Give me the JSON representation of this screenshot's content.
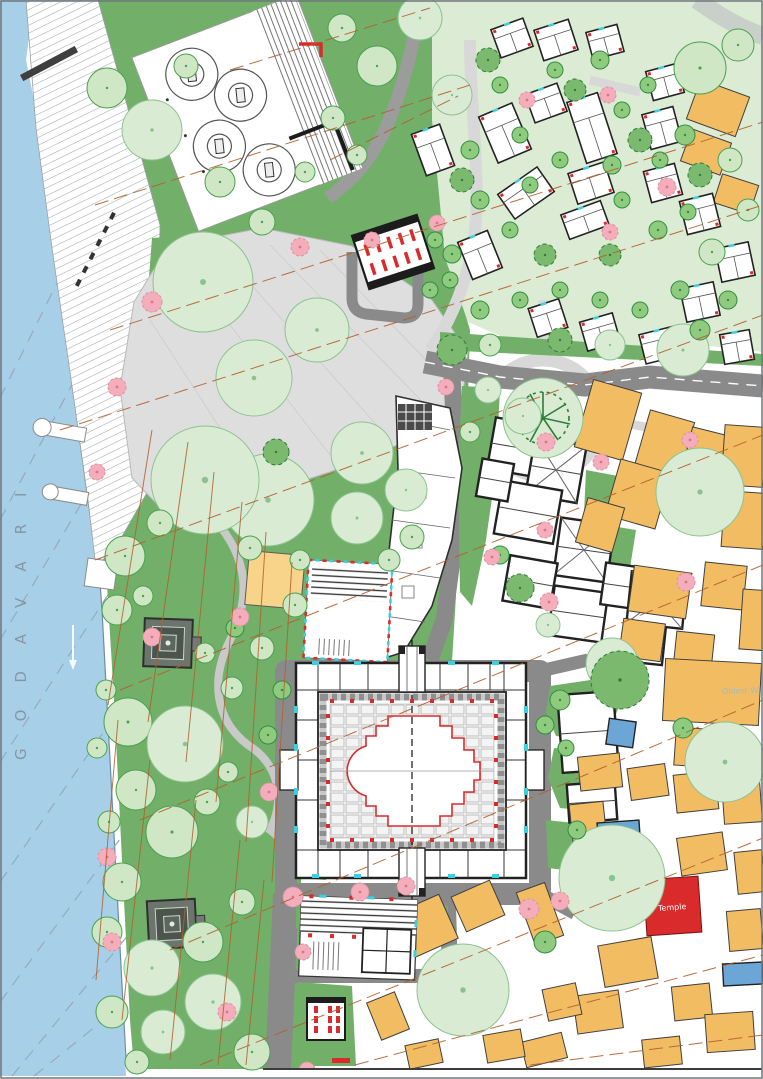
{
  "title": "Riverfront temple precinct master plan",
  "labels": {
    "river_name": "GODAVARI",
    "temple": "Temple",
    "note": "Oldest W"
  },
  "colors": {
    "river": "#a7d0e8",
    "riverEdge": "#6b8da6",
    "riverDash": "#93aabf",
    "park": "#72b069",
    "pale_bg": "#dcebd4",
    "plaza": "#dedede",
    "plazaEdge": "#b8b8b8",
    "road": "#8a8a8a",
    "roadLight": "#d8d8d8",
    "pathLight": "#c9cfc9",
    "treeLight": "#cfe7c4",
    "treeLightEdge": "#4aa050",
    "treePale": "#d9ecd3",
    "treePaleEdge": "#8cc290",
    "treeBright": "#8fca7f",
    "treeBrightEdge": "#2f8f3f",
    "canopy": "#7ab96e",
    "canopyEdge": "#2e7d3a",
    "pink": "#f4adba",
    "pinkEdge": "#e08ea1",
    "orange": "#f2bd62",
    "orangeEdge": "#4a3a22",
    "yellow": "#f7d489",
    "wall": "#222222",
    "red": "#d92b2b",
    "cyan": "#3ccfe0",
    "blue": "#6ba6d6",
    "contour": "#b2602e",
    "label_gray": "#7f8d98",
    "label_blue": "#9fb9cf",
    "shrine": "#5a675c",
    "frame": "#6f767c"
  },
  "features": {
    "trees": [
      [
        107,
        88,
        20,
        0
      ],
      [
        152,
        130,
        30,
        1
      ],
      [
        186,
        66,
        12,
        0
      ],
      [
        220,
        182,
        15,
        0
      ],
      [
        262,
        222,
        13,
        0
      ],
      [
        342,
        28,
        14,
        0
      ],
      [
        377,
        66,
        20,
        0
      ],
      [
        420,
        18,
        22,
        1
      ],
      [
        333,
        118,
        12,
        0
      ],
      [
        305,
        172,
        10,
        0
      ],
      [
        357,
        155,
        10,
        0
      ],
      [
        452,
        95,
        20,
        1
      ],
      [
        700,
        68,
        26,
        0
      ],
      [
        738,
        45,
        16,
        0
      ],
      [
        748,
        210,
        11,
        0
      ],
      [
        730,
        160,
        12,
        0
      ],
      [
        712,
        252,
        13,
        0
      ],
      [
        203,
        282,
        50,
        1
      ],
      [
        254,
        378,
        38,
        1
      ],
      [
        317,
        330,
        32,
        1
      ],
      [
        268,
        500,
        46,
        1
      ],
      [
        205,
        480,
        54,
        1
      ],
      [
        362,
        453,
        31,
        1
      ],
      [
        357,
        518,
        26,
        1
      ],
      [
        406,
        490,
        21,
        1
      ],
      [
        412,
        537,
        12,
        0
      ],
      [
        389,
        560,
        11,
        0
      ],
      [
        125,
        556,
        20,
        0
      ],
      [
        160,
        523,
        13,
        0
      ],
      [
        117,
        610,
        15,
        0
      ],
      [
        143,
        596,
        10,
        0
      ],
      [
        106,
        690,
        10,
        0
      ],
      [
        128,
        722,
        24,
        0
      ],
      [
        185,
        744,
        38,
        1
      ],
      [
        136,
        790,
        20,
        0
      ],
      [
        109,
        822,
        11,
        0
      ],
      [
        172,
        832,
        26,
        0
      ],
      [
        228,
        772,
        10,
        0
      ],
      [
        207,
        802,
        13,
        0
      ],
      [
        252,
        822,
        16,
        1
      ],
      [
        122,
        882,
        19,
        0
      ],
      [
        107,
        932,
        15,
        0
      ],
      [
        152,
        968,
        28,
        1
      ],
      [
        203,
        942,
        20,
        0
      ],
      [
        242,
        902,
        13,
        0
      ],
      [
        112,
        1012,
        16,
        0
      ],
      [
        163,
        1032,
        22,
        1
      ],
      [
        213,
        1002,
        28,
        1
      ],
      [
        252,
        1052,
        18,
        0
      ],
      [
        137,
        1062,
        12,
        0
      ],
      [
        97,
        748,
        10,
        0
      ],
      [
        232,
        688,
        11,
        0
      ],
      [
        262,
        648,
        12,
        0
      ],
      [
        205,
        653,
        10,
        0
      ],
      [
        250,
        548,
        12,
        0
      ],
      [
        300,
        560,
        10,
        0
      ],
      [
        295,
        605,
        12,
        0
      ],
      [
        488,
        390,
        13,
        1
      ],
      [
        523,
        416,
        18,
        1
      ],
      [
        470,
        432,
        10,
        0
      ],
      [
        610,
        345,
        15,
        1
      ],
      [
        683,
        350,
        26,
        1
      ],
      [
        700,
        492,
        44,
        1
      ],
      [
        725,
        762,
        40,
        1
      ],
      [
        683,
        728,
        10,
        2
      ],
      [
        612,
        878,
        53,
        1
      ],
      [
        463,
        990,
        46,
        1
      ],
      [
        545,
        942,
        11,
        2
      ],
      [
        612,
        664,
        26,
        1
      ],
      [
        548,
        625,
        12,
        1
      ],
      [
        560,
        700,
        10,
        2
      ],
      [
        545,
        725,
        9,
        2
      ],
      [
        566,
        748,
        8,
        2
      ],
      [
        282,
        690,
        9,
        2
      ],
      [
        268,
        735,
        9,
        2
      ],
      [
        490,
        345,
        11,
        0
      ],
      [
        452,
        350,
        15,
        3
      ],
      [
        560,
        340,
        12,
        3
      ],
      [
        620,
        680,
        29,
        3
      ],
      [
        520,
        588,
        14,
        3
      ],
      [
        276,
        452,
        13,
        3
      ],
      [
        235,
        628,
        9,
        2
      ],
      [
        577,
        830,
        9,
        2
      ],
      [
        452,
        254,
        9,
        2
      ],
      [
        430,
        290,
        8,
        2
      ],
      [
        500,
        555,
        9,
        2
      ],
      [
        470,
        150,
        9,
        2
      ],
      [
        500,
        85,
        8,
        2
      ],
      [
        520,
        135,
        8,
        2
      ],
      [
        555,
        70,
        8,
        2
      ],
      [
        600,
        60,
        9,
        2
      ],
      [
        622,
        110,
        8,
        2
      ],
      [
        648,
        85,
        8,
        2
      ],
      [
        685,
        135,
        10,
        2
      ],
      [
        660,
        160,
        8,
        2
      ],
      [
        612,
        165,
        9,
        2
      ],
      [
        560,
        160,
        8,
        2
      ],
      [
        530,
        185,
        8,
        2
      ],
      [
        480,
        200,
        9,
        2
      ],
      [
        510,
        230,
        8,
        2
      ],
      [
        622,
        200,
        8,
        2
      ],
      [
        658,
        230,
        9,
        2
      ],
      [
        688,
        212,
        8,
        2
      ],
      [
        680,
        290,
        9,
        2
      ],
      [
        640,
        310,
        8,
        2
      ],
      [
        600,
        300,
        8,
        2
      ],
      [
        560,
        290,
        8,
        2
      ],
      [
        520,
        300,
        8,
        2
      ],
      [
        480,
        310,
        9,
        2
      ],
      [
        450,
        280,
        8,
        2
      ],
      [
        435,
        240,
        8,
        2
      ],
      [
        700,
        330,
        10,
        2
      ],
      [
        728,
        300,
        9,
        2
      ],
      [
        488,
        60,
        12,
        3
      ],
      [
        575,
        90,
        11,
        3
      ],
      [
        640,
        140,
        12,
        3
      ],
      [
        462,
        180,
        12,
        3
      ],
      [
        700,
        175,
        12,
        3
      ],
      [
        545,
        255,
        11,
        3
      ],
      [
        610,
        255,
        11,
        3
      ]
    ],
    "pink_trees": [
      [
        152,
        302,
        10
      ],
      [
        117,
        387,
        9
      ],
      [
        97,
        472,
        8
      ],
      [
        240,
        617,
        9
      ],
      [
        152,
        637,
        9
      ],
      [
        269,
        792,
        9
      ],
      [
        107,
        857,
        9
      ],
      [
        293,
        897,
        10
      ],
      [
        360,
        892,
        9
      ],
      [
        406,
        886,
        9
      ],
      [
        303,
        952,
        8
      ],
      [
        112,
        942,
        9
      ],
      [
        227,
        1012,
        9
      ],
      [
        307,
        1070,
        8
      ],
      [
        527,
        100,
        8
      ],
      [
        610,
        232,
        8
      ],
      [
        667,
        187,
        9
      ],
      [
        446,
        387,
        8
      ],
      [
        546,
        442,
        9
      ],
      [
        601,
        462,
        8
      ],
      [
        492,
        557,
        8
      ],
      [
        549,
        602,
        9
      ],
      [
        686,
        582,
        9
      ],
      [
        529,
        909,
        10
      ],
      [
        560,
        901,
        9
      ],
      [
        437,
        223,
        8
      ],
      [
        372,
        240,
        8
      ],
      [
        300,
        247,
        9
      ],
      [
        545,
        530,
        8
      ],
      [
        608,
        95,
        8
      ],
      [
        690,
        440,
        8
      ]
    ],
    "orange_buildings": [
      [
        718,
        108,
        52,
        42,
        20
      ],
      [
        706,
        152,
        42,
        34,
        20
      ],
      [
        736,
        194,
        38,
        30,
        18
      ],
      [
        608,
        420,
        50,
        70,
        16
      ],
      [
        664,
        446,
        46,
        62,
        16
      ],
      [
        638,
        494,
        52,
        58,
        16
      ],
      [
        600,
        525,
        38,
        46,
        16
      ],
      [
        700,
        472,
        36,
        84,
        14
      ],
      [
        744,
        456,
        42,
        60,
        4
      ],
      [
        744,
        520,
        42,
        56,
        4
      ],
      [
        660,
        592,
        58,
        46,
        8
      ],
      [
        724,
        586,
        42,
        44,
        6
      ],
      [
        642,
        640,
        42,
        38,
        8
      ],
      [
        694,
        650,
        38,
        34,
        6
      ],
      [
        712,
        692,
        96,
        62,
        3
      ],
      [
        704,
        748,
        58,
        38,
        4
      ],
      [
        756,
        620,
        30,
        60,
        4
      ],
      [
        600,
        772,
        42,
        34,
        -6
      ],
      [
        648,
        782,
        38,
        32,
        -8
      ],
      [
        696,
        792,
        42,
        38,
        -6
      ],
      [
        742,
        802,
        38,
        42,
        -4
      ],
      [
        588,
        822,
        34,
        38,
        -6
      ],
      [
        702,
        854,
        46,
        38,
        -8
      ],
      [
        750,
        872,
        28,
        42,
        -6
      ],
      [
        745,
        930,
        34,
        40,
        -5
      ],
      [
        628,
        962,
        54,
        42,
        -10
      ],
      [
        692,
        1002,
        38,
        34,
        -6
      ],
      [
        598,
        1012,
        46,
        38,
        -8
      ],
      [
        730,
        1032,
        48,
        38,
        -4
      ],
      [
        662,
        1052,
        38,
        28,
        -6
      ],
      [
        562,
        1002,
        34,
        32,
        -12
      ],
      [
        544,
        1050,
        42,
        26,
        -14
      ],
      [
        422,
        928,
        58,
        48,
        -24
      ],
      [
        478,
        906,
        42,
        38,
        -24
      ],
      [
        540,
        914,
        30,
        56,
        -20
      ],
      [
        504,
        1046,
        38,
        28,
        -10
      ],
      [
        424,
        1054,
        34,
        24,
        -12
      ],
      [
        388,
        1016,
        30,
        40,
        -22
      ]
    ],
    "villas": [
      [
        512,
        38,
        34,
        30,
        -20
      ],
      [
        556,
        40,
        36,
        32,
        -18
      ],
      [
        605,
        42,
        32,
        28,
        -15
      ],
      [
        665,
        82,
        32,
        30,
        -15
      ],
      [
        433,
        150,
        30,
        44,
        -20
      ],
      [
        505,
        133,
        36,
        50,
        -23
      ],
      [
        546,
        103,
        34,
        30,
        -20
      ],
      [
        592,
        128,
        32,
        64,
        -18
      ],
      [
        662,
        128,
        32,
        36,
        -15
      ],
      [
        591,
        183,
        38,
        32,
        -18
      ],
      [
        526,
        193,
        48,
        30,
        -35
      ],
      [
        585,
        220,
        42,
        26,
        -20
      ],
      [
        663,
        183,
        32,
        32,
        -15
      ],
      [
        700,
        214,
        34,
        34,
        -14
      ],
      [
        735,
        262,
        34,
        34,
        -12
      ],
      [
        700,
        302,
        34,
        34,
        -12
      ],
      [
        660,
        345,
        36,
        30,
        -14
      ],
      [
        600,
        332,
        34,
        30,
        -16
      ],
      [
        548,
        318,
        32,
        30,
        -18
      ],
      [
        737,
        347,
        30,
        30,
        -10
      ],
      [
        480,
        255,
        32,
        40,
        -22
      ]
    ],
    "heritage_buildings": [
      [
        520,
        448,
        58,
        52,
        10,
        0
      ],
      [
        556,
        470,
        52,
        58,
        10,
        1
      ],
      [
        528,
        512,
        60,
        54,
        10,
        0
      ],
      [
        584,
        550,
        54,
        58,
        8,
        1
      ],
      [
        530,
        582,
        48,
        46,
        10,
        0
      ],
      [
        578,
        614,
        54,
        50,
        8,
        0
      ],
      [
        622,
        586,
        38,
        42,
        8,
        0
      ],
      [
        495,
        480,
        32,
        38,
        10,
        0
      ],
      [
        657,
        600,
        56,
        52,
        6,
        1
      ],
      [
        643,
        644,
        42,
        38,
        6,
        0
      ],
      [
        588,
        732,
        56,
        78,
        -4,
        0
      ],
      [
        592,
        802,
        48,
        38,
        -4,
        0
      ]
    ],
    "blue_buildings": [
      [
        621,
        733,
        27,
        26,
        8
      ],
      [
        619,
        836,
        42,
        29,
        -4
      ],
      [
        743,
        974,
        40,
        22,
        -3
      ]
    ],
    "contours": [
      [
        95,
        205,
        470,
        85
      ],
      [
        110,
        330,
        763,
        122
      ],
      [
        60,
        430,
        763,
        205
      ],
      [
        95,
        560,
        763,
        315
      ],
      [
        120,
        690,
        763,
        435
      ],
      [
        140,
        820,
        763,
        565
      ],
      [
        170,
        950,
        763,
        700
      ],
      [
        200,
        1065,
        763,
        838
      ],
      [
        355,
        1065,
        763,
        955
      ],
      [
        530,
        1065,
        763,
        1035
      ],
      [
        230,
        70,
        430,
        8
      ],
      [
        330,
        160,
        458,
        96
      ]
    ],
    "park_contours": [
      [
        152,
        430,
        108,
        705
      ],
      [
        188,
        442,
        148,
        722
      ],
      [
        214,
        472,
        186,
        762
      ],
      [
        242,
        502,
        216,
        802
      ],
      [
        266,
        532,
        246,
        842
      ],
      [
        292,
        562,
        272,
        882
      ],
      [
        240,
        840,
        218,
        1065
      ],
      [
        264,
        880,
        246,
        1065
      ],
      [
        196,
        800,
        170,
        1060
      ],
      [
        150,
        760,
        122,
        1020
      ],
      [
        118,
        720,
        96,
        980
      ]
    ],
    "river_dashes": [
      [
        0,
        398,
        102,
        192
      ],
      [
        0,
        520,
        116,
        302
      ],
      [
        0,
        640,
        130,
        422
      ],
      [
        0,
        762,
        142,
        542
      ],
      [
        0,
        882,
        152,
        662
      ],
      [
        0,
        1002,
        162,
        782
      ],
      [
        12,
        1076,
        172,
        882
      ],
      [
        34,
        1076,
        188,
        952
      ]
    ]
  }
}
